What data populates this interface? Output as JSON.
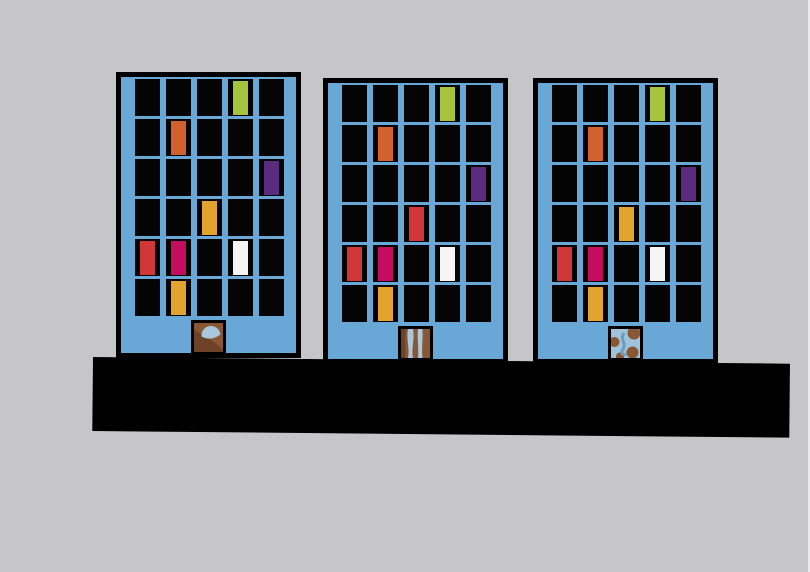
{
  "scene": {
    "width": 810,
    "height": 572,
    "background": "#c6c6c8",
    "ground_bar": {
      "color": "#000000",
      "x": 93,
      "y": 357,
      "width": 697,
      "height": 74,
      "tilt_deg": 0.55
    }
  },
  "palette": {
    "building_blue": "#69a7d6",
    "frame_black": "#000000",
    "window_black": "#040404",
    "green": "#a6c33c",
    "orange": "#d2622d",
    "purple": "#5b2b80",
    "amber": "#e2a42e",
    "red": "#d13639",
    "magenta": "#c50d5f",
    "white": "#f5f5f6",
    "door_brown": "#8a5733",
    "door_brown_dark": "#6d4226",
    "door_blue": "#a9c8de",
    "door_pale_blue": "#9fc3da",
    "door_blue_deep": "#6e9cc0"
  },
  "grid": {
    "rows": 6,
    "cols": 5
  },
  "buildings": [
    {
      "id": "building-1",
      "x": 116,
      "y": 72,
      "width": 185,
      "height": 286,
      "door": "fan",
      "colored_windows": [
        {
          "row": 1,
          "col": 4,
          "color": "green"
        },
        {
          "row": 2,
          "col": 2,
          "color": "orange"
        },
        {
          "row": 3,
          "col": 5,
          "color": "purple"
        },
        {
          "row": 4,
          "col": 3,
          "color": "amber"
        },
        {
          "row": 5,
          "col": 1,
          "color": "red"
        },
        {
          "row": 5,
          "col": 2,
          "color": "magenta"
        },
        {
          "row": 5,
          "col": 4,
          "color": "white"
        },
        {
          "row": 6,
          "col": 2,
          "color": "amber"
        }
      ]
    },
    {
      "id": "building-2",
      "x": 323,
      "y": 78,
      "width": 185,
      "height": 286,
      "door": "stripes",
      "colored_windows": [
        {
          "row": 1,
          "col": 4,
          "color": "green"
        },
        {
          "row": 2,
          "col": 2,
          "color": "orange"
        },
        {
          "row": 3,
          "col": 5,
          "color": "purple"
        },
        {
          "row": 4,
          "col": 3,
          "color": "red"
        },
        {
          "row": 5,
          "col": 1,
          "color": "red"
        },
        {
          "row": 5,
          "col": 2,
          "color": "magenta"
        },
        {
          "row": 5,
          "col": 4,
          "color": "white"
        },
        {
          "row": 6,
          "col": 2,
          "color": "amber"
        }
      ]
    },
    {
      "id": "building-3",
      "x": 533,
      "y": 78,
      "width": 185,
      "height": 286,
      "door": "globe",
      "colored_windows": [
        {
          "row": 1,
          "col": 4,
          "color": "green"
        },
        {
          "row": 2,
          "col": 2,
          "color": "orange"
        },
        {
          "row": 3,
          "col": 5,
          "color": "purple"
        },
        {
          "row": 4,
          "col": 3,
          "color": "amber"
        },
        {
          "row": 5,
          "col": 1,
          "color": "red"
        },
        {
          "row": 5,
          "col": 2,
          "color": "magenta"
        },
        {
          "row": 5,
          "col": 4,
          "color": "white"
        },
        {
          "row": 6,
          "col": 2,
          "color": "amber"
        }
      ]
    }
  ]
}
